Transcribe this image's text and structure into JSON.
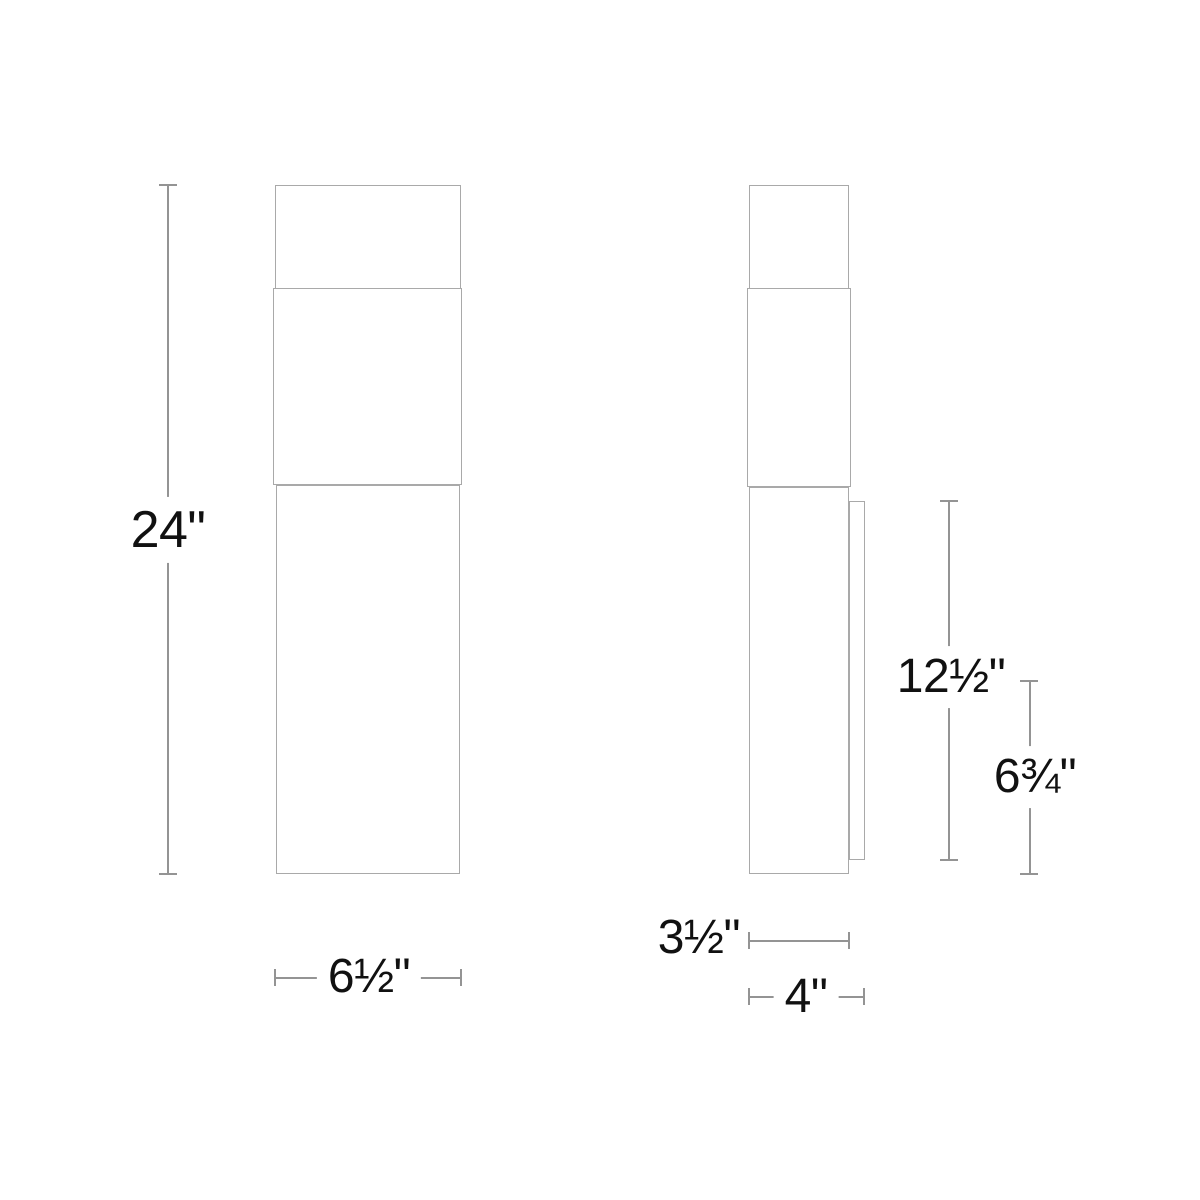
{
  "drawing": {
    "type": "technical-dimension-diagram",
    "colors": {
      "background": "#ffffff",
      "outline": "#a9a9a9",
      "dimension_line": "#949494",
      "text": "#111111"
    },
    "dimensions": {
      "overall_height": "24\"",
      "overall_width": "6½\"",
      "backplate_height": "12½\"",
      "center_height": "6¾\"",
      "body_depth": "3½\"",
      "overall_depth": "4\""
    }
  }
}
